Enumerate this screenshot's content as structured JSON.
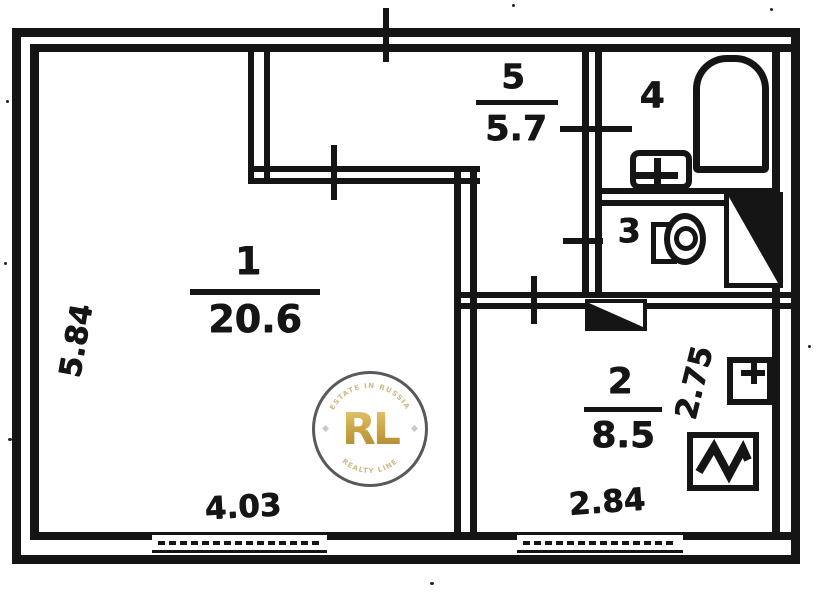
{
  "plan": {
    "type": "apartment-floor-plan",
    "rooms": [
      {
        "number": "1",
        "area": "20.6"
      },
      {
        "number": "2",
        "area": "8.5"
      },
      {
        "number": "3"
      },
      {
        "number": "4"
      },
      {
        "number": "5",
        "area": "5.7"
      }
    ],
    "dimensions": {
      "left_height": "5.84",
      "bottom_left_width": "4.03",
      "bottom_right_width": "2.84",
      "right_height": "2.75"
    },
    "watermark": {
      "monogram": "RL",
      "arc_top": "ESTATE IN RUSSIA",
      "arc_bottom": "REALTY LINE",
      "gold_color": "#c49a3c",
      "ring_color": "#4a4a4a"
    },
    "colors": {
      "ink": "#151515",
      "paper": "#ffffff"
    },
    "fixtures": [
      "bathtub",
      "sink",
      "toilet",
      "vent-shaft",
      "vent-box",
      "ventilation-duct-symbol",
      "door-swing",
      "window"
    ]
  }
}
